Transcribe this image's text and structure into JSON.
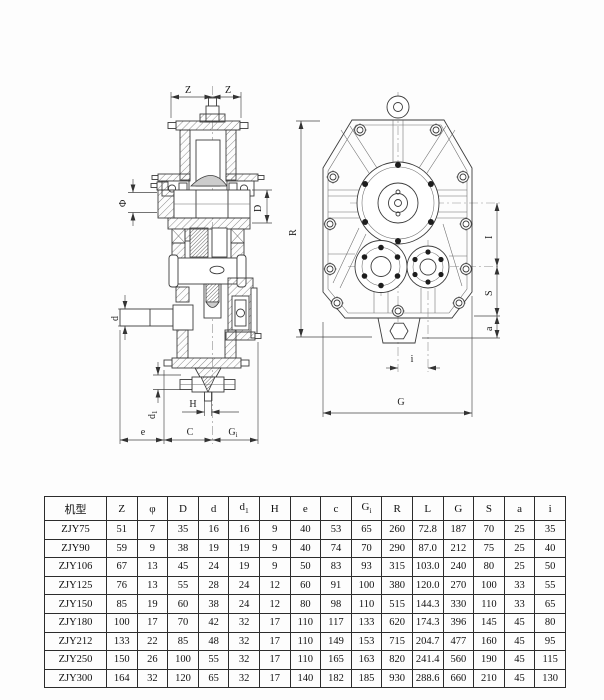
{
  "drawing": {
    "line_color": "#3c3c3c",
    "labels": {
      "z": "Z",
      "phi": "Φ",
      "D": "D",
      "d": "d",
      "d1": "d",
      "d1sub": "1",
      "H": "H",
      "e": "e",
      "C": "C",
      "G1": "G",
      "G1sub": "i",
      "R": "R",
      "I": "I",
      "S": "S",
      "a": "a",
      "G": "G",
      "i": "i"
    }
  },
  "table": {
    "columns": [
      {
        "label": "机型"
      },
      {
        "label": "Z"
      },
      {
        "label": "φ"
      },
      {
        "label": "D"
      },
      {
        "label": "d"
      },
      {
        "label": "d",
        "sub": "1"
      },
      {
        "label": "H"
      },
      {
        "label": "e"
      },
      {
        "label": "c"
      },
      {
        "label": "G",
        "sub": "i"
      },
      {
        "label": "R"
      },
      {
        "label": "L"
      },
      {
        "label": "G"
      },
      {
        "label": "S"
      },
      {
        "label": "a"
      },
      {
        "label": "i"
      }
    ],
    "rows": [
      [
        "ZJY75",
        "51",
        "7",
        "35",
        "16",
        "16",
        "9",
        "40",
        "53",
        "65",
        "260",
        "72.8",
        "187",
        "70",
        "25",
        "35"
      ],
      [
        "ZJY90",
        "59",
        "9",
        "38",
        "19",
        "19",
        "9",
        "40",
        "74",
        "70",
        "290",
        "87.0",
        "212",
        "75",
        "25",
        "40"
      ],
      [
        "ZJY106",
        "67",
        "13",
        "45",
        "24",
        "19",
        "9",
        "50",
        "83",
        "93",
        "315",
        "103.0",
        "240",
        "80",
        "25",
        "50"
      ],
      [
        "ZJY125",
        "76",
        "13",
        "55",
        "28",
        "24",
        "12",
        "60",
        "91",
        "100",
        "380",
        "120.0",
        "270",
        "100",
        "33",
        "55"
      ],
      [
        "ZJY150",
        "85",
        "19",
        "60",
        "38",
        "24",
        "12",
        "80",
        "98",
        "110",
        "515",
        "144.3",
        "330",
        "110",
        "33",
        "65"
      ],
      [
        "ZJY180",
        "100",
        "17",
        "70",
        "42",
        "32",
        "17",
        "110",
        "117",
        "133",
        "620",
        "174.3",
        "396",
        "145",
        "45",
        "80"
      ],
      [
        "ZJY212",
        "133",
        "22",
        "85",
        "48",
        "32",
        "17",
        "110",
        "149",
        "153",
        "715",
        "204.7",
        "477",
        "160",
        "45",
        "95"
      ],
      [
        "ZJY250",
        "150",
        "26",
        "100",
        "55",
        "32",
        "17",
        "110",
        "165",
        "163",
        "820",
        "241.4",
        "560",
        "190",
        "45",
        "115"
      ],
      [
        "ZJY300",
        "164",
        "32",
        "120",
        "65",
        "32",
        "17",
        "140",
        "182",
        "185",
        "930",
        "288.6",
        "660",
        "210",
        "45",
        "130"
      ]
    ]
  }
}
